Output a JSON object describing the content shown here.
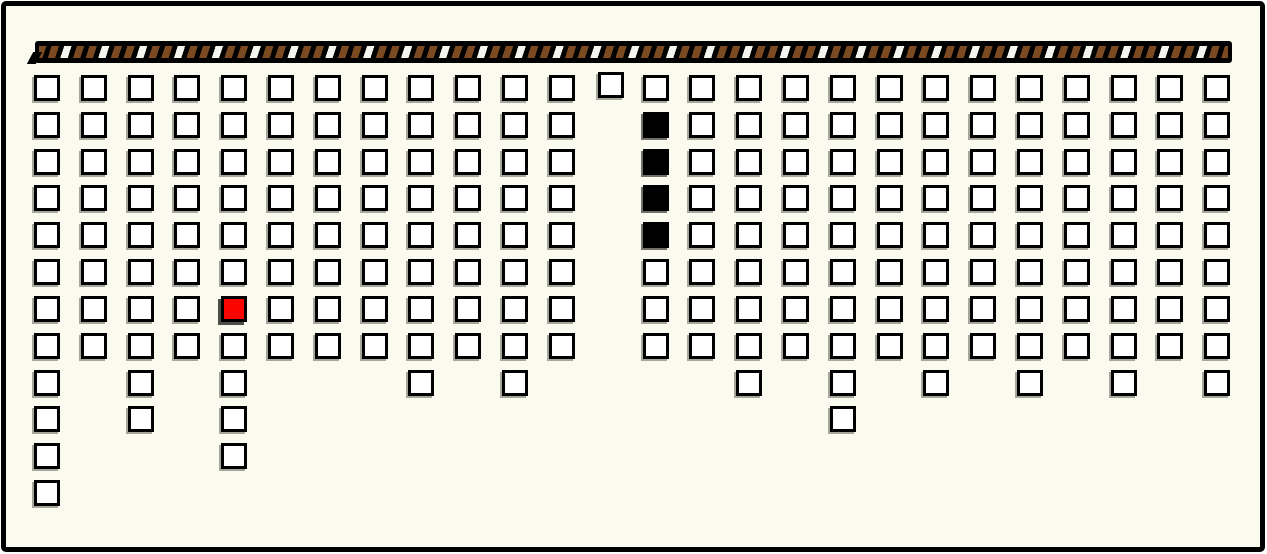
{
  "app": {
    "description": "unit-square histogram board hanging from a striped rod",
    "page_bg": "#FAFAEE",
    "frame_border_color": "#000000"
  },
  "top_bar": {
    "role": "striped-rod",
    "bar_bg": "#000000",
    "stripe_brown": "#7B4A21",
    "stripe_white": "#F4F4F0",
    "x": 35,
    "y": 41,
    "width": 1197,
    "height": 22
  },
  "chart_data": {
    "type": "bar",
    "subtype": "unit-square-columns-hanging-from-top",
    "title": "",
    "xlabel": "",
    "ylabel": "",
    "columns": 26,
    "rows_max": 12,
    "origin_x": 34,
    "origin_y": 75,
    "spacing_x": 46.81,
    "spacing_y": 36.82,
    "cell_outer_size": 26,
    "cell_fill": "#FFFFFF",
    "cell_border": "#000000",
    "column_heights": [
      12,
      8,
      10,
      8,
      11,
      8,
      8,
      8,
      9,
      8,
      9,
      8,
      1,
      8,
      8,
      9,
      8,
      10,
      8,
      9,
      8,
      9,
      8,
      9,
      8,
      9
    ],
    "special_cells": [
      {
        "col": 5,
        "row": 7,
        "state": "red",
        "hex": "#FA0400"
      },
      {
        "col": 14,
        "row": 2,
        "state": "black",
        "hex": "#000000"
      },
      {
        "col": 14,
        "row": 3,
        "state": "black",
        "hex": "#000000"
      },
      {
        "col": 14,
        "row": 4,
        "state": "black",
        "hex": "#000000"
      },
      {
        "col": 14,
        "row": 5,
        "state": "black",
        "hex": "#000000"
      }
    ],
    "offset_cells": [
      {
        "col": 13,
        "row": 1,
        "dx": 2,
        "dy": -3
      }
    ],
    "legend": [],
    "grid": "off"
  }
}
